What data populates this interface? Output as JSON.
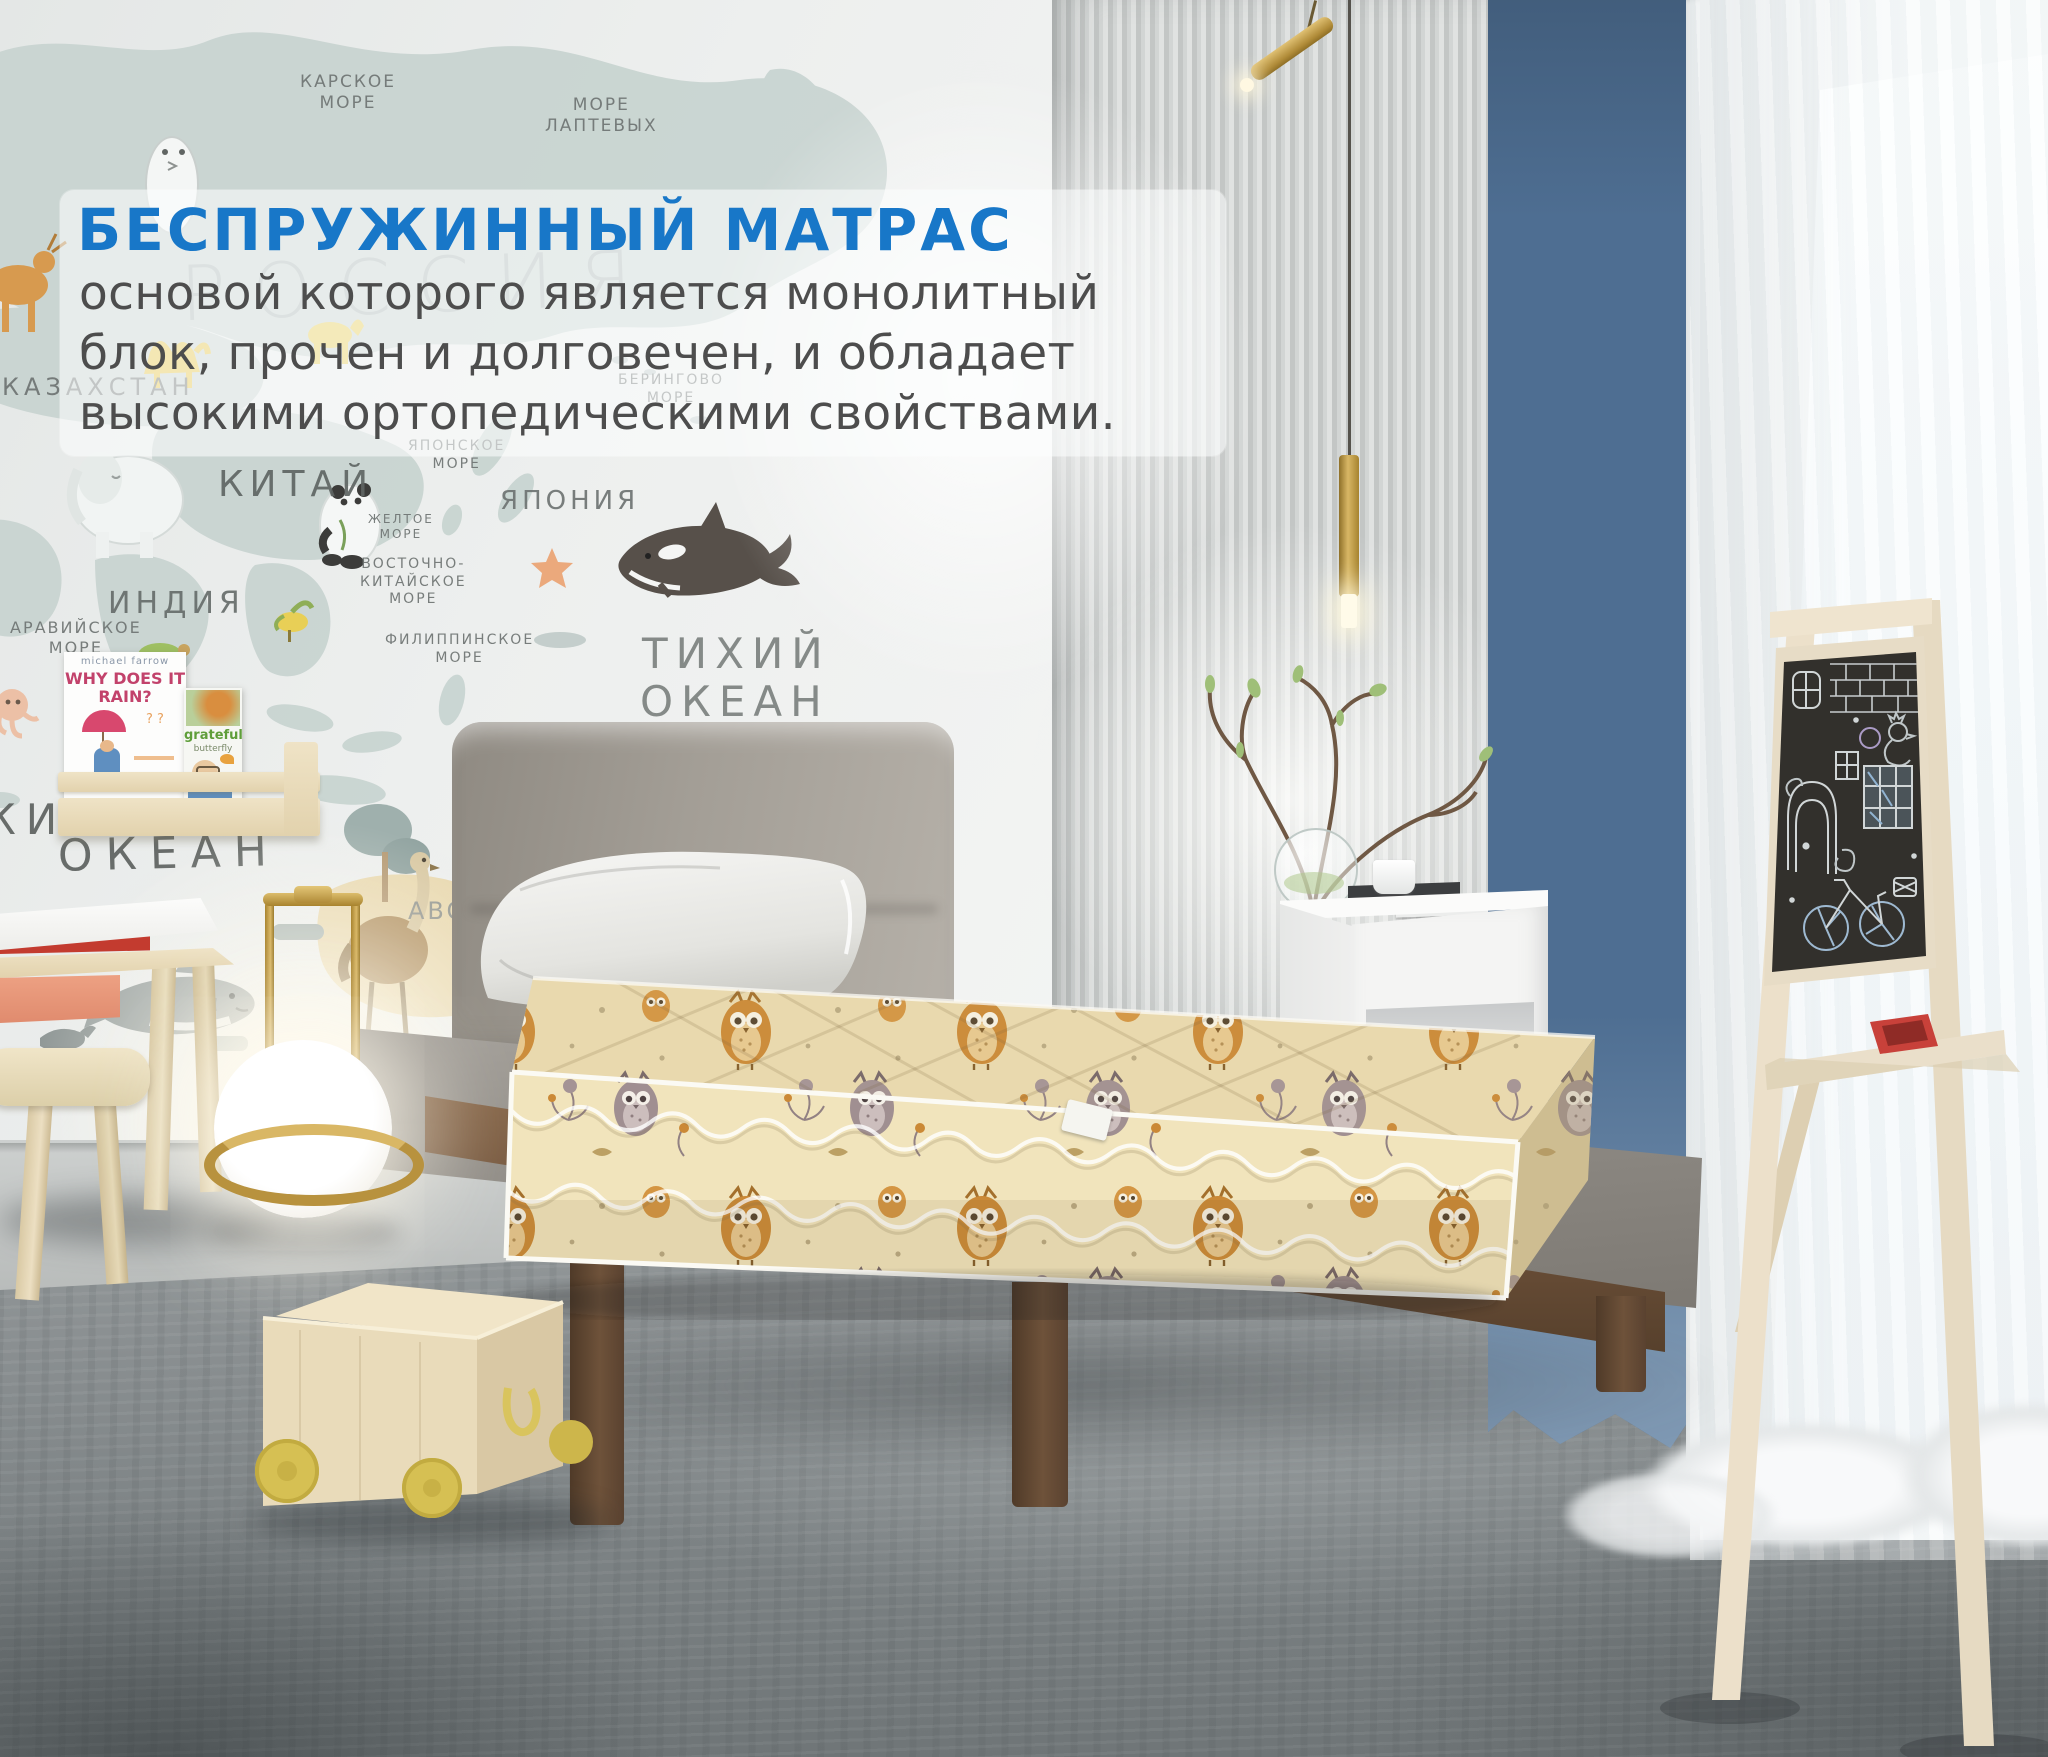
{
  "overlay": {
    "title": "БЕСПРУЖИННЫЙ МАТРАС",
    "line1": "основой которого является монолитный",
    "line2": "блок, прочен и долговечен, и обладает",
    "line3": "высокими ортопедическими свойствами.",
    "title_color": "#1877c8",
    "body_color": "#4d4d4d"
  },
  "map": {
    "russia": "РОССИЯ",
    "kazakhstan": "КАЗАХСТАН",
    "china": "КИТАЙ",
    "india": "ИНДИЯ",
    "japan": "ЯПОНИЯ",
    "kara_sea": "КАРСКОЕ\nМОРЕ",
    "laptev_sea": "МОРЕ\nЛАПТЕВЫХ",
    "bering_sea": "БЕРИНГОВО\nМОРЕ",
    "japan_sea": "ЯПОНСКОЕ\nМОРЕ",
    "yellow_sea": "ЖЕЛТОЕ\nМОРЕ",
    "east_china_sea": "ВОСТОЧНО-\nКИТАЙСКОЕ\nМОРЕ",
    "philippine_sea": "ФИЛИППИНСКОЕ\nМОРЕ",
    "arabian_sea": "АРАВИЙСКОЕ\nМОРЕ",
    "pacific_line1": "ТИХИЙ",
    "pacific_line2": "ОКЕАН",
    "indian_ocean_word": "ИНДИЙСКИЙ",
    "ocean_big": "ОКЕАН",
    "abc": "ABC"
  },
  "books": {
    "book1_author": "michael farrow",
    "book1_title": "WHY DOES IT RAIN?",
    "book2_title": "grateful",
    "book2_subtitle": "butterfly"
  },
  "colors": {
    "accent_blue": "#1877c8",
    "body_text": "#4d4d4d",
    "curtain_blue": "#5f83a8",
    "mattress_cream": "#efe2ba",
    "owl_orange": "#c9842f",
    "owl_taupe": "#9c8b8f",
    "bed_wood": "#6e523a",
    "toy_wood": "#e8d9ba",
    "wheel_yellow": "#d6c053",
    "brass": "#b8923e",
    "chalkboard": "#32302c"
  }
}
